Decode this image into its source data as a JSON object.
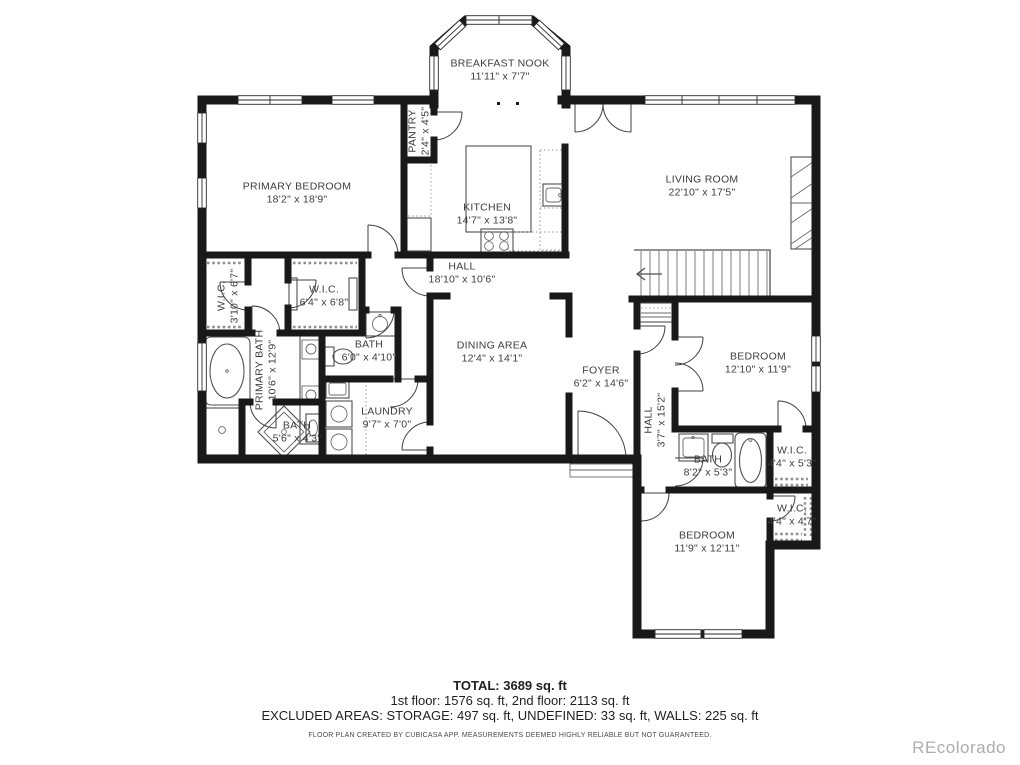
{
  "plan": {
    "rooms": [
      {
        "name": "BREAKFAST NOOK",
        "dims": "11'11\" x 7'7\"",
        "x": 500,
        "y": 70,
        "rotate": 0
      },
      {
        "name": "PRIMARY BEDROOM",
        "dims": "18'2\" x 18'9\"",
        "x": 297,
        "y": 193,
        "rotate": 0
      },
      {
        "name": "PANTRY",
        "dims": "2'4\" x 4'5\"",
        "x": 419,
        "y": 131,
        "rotate": -90
      },
      {
        "name": "KITCHEN",
        "dims": "14'7\" x 13'8\"",
        "x": 487,
        "y": 214,
        "rotate": 0
      },
      {
        "name": "LIVING ROOM",
        "dims": "22'10\" x 17'5\"",
        "x": 702,
        "y": 186,
        "rotate": 0
      },
      {
        "name": "HALL",
        "dims": "18'10\" x 10'6\"",
        "x": 462,
        "y": 273,
        "rotate": 0
      },
      {
        "name": "W.I.C.",
        "dims": "3'10\" x 6'7\"",
        "x": 228,
        "y": 296,
        "rotate": -90
      },
      {
        "name": "W.I.C.",
        "dims": "6'4\" x 6'8\"",
        "x": 324,
        "y": 296,
        "rotate": 0
      },
      {
        "name": "PRIMARY BATH",
        "dims": "10'6\" x 12'9\"",
        "x": 266,
        "y": 370,
        "rotate": -90
      },
      {
        "name": "BATH",
        "dims": "6'0\" x 4'10\"",
        "x": 369,
        "y": 351,
        "rotate": 0
      },
      {
        "name": "DINING AREA",
        "dims": "12'4\" x 14'1\"",
        "x": 492,
        "y": 352,
        "rotate": 0
      },
      {
        "name": "FOYER",
        "dims": "6'2\" x 14'6\"",
        "x": 601,
        "y": 377,
        "rotate": 0
      },
      {
        "name": "LAUNDRY",
        "dims": "9'7\" x 7'0\"",
        "x": 387,
        "y": 418,
        "rotate": 0
      },
      {
        "name": "BATH",
        "dims": "5'6\" x 4'3\"",
        "x": 297,
        "y": 432,
        "rotate": 0
      },
      {
        "name": "HALL",
        "dims": "3'7\" x 15'2\"",
        "x": 655,
        "y": 420,
        "rotate": -90
      },
      {
        "name": "BEDROOM",
        "dims": "12'10\" x 11'9\"",
        "x": 758,
        "y": 363,
        "rotate": 0
      },
      {
        "name": "BATH",
        "dims": "8'2\" x 5'3\"",
        "x": 708,
        "y": 466,
        "rotate": 0
      },
      {
        "name": "W.I.C.",
        "dims": "4'4\" x 5'3\"",
        "x": 792,
        "y": 457,
        "rotate": 0
      },
      {
        "name": "W.I.C.",
        "dims": "4'4\" x 4'7\"",
        "x": 792,
        "y": 515,
        "rotate": 0
      },
      {
        "name": "BEDROOM",
        "dims": "11'9\" x 12'11\"",
        "x": 707,
        "y": 542,
        "rotate": 0
      }
    ]
  },
  "footer": {
    "total": "TOTAL: 3689 sq. ft",
    "floors": "1st floor: 1576 sq. ft, 2nd floor: 2113 sq. ft",
    "excluded": "EXCLUDED AREAS: STORAGE: 497 sq. ft, UNDEFINED: 33 sq. ft, WALLS: 225 sq. ft",
    "disclaimer": "FLOOR PLAN CREATED BY CUBICASA APP. MEASUREMENTS DEEMED HIGHLY RELIABLE BUT NOT GUARANTEED."
  },
  "watermark": "REcolorado",
  "colors": {
    "wall": "#191919",
    "label": "#3d3d3d",
    "watermark": "#adadad"
  }
}
